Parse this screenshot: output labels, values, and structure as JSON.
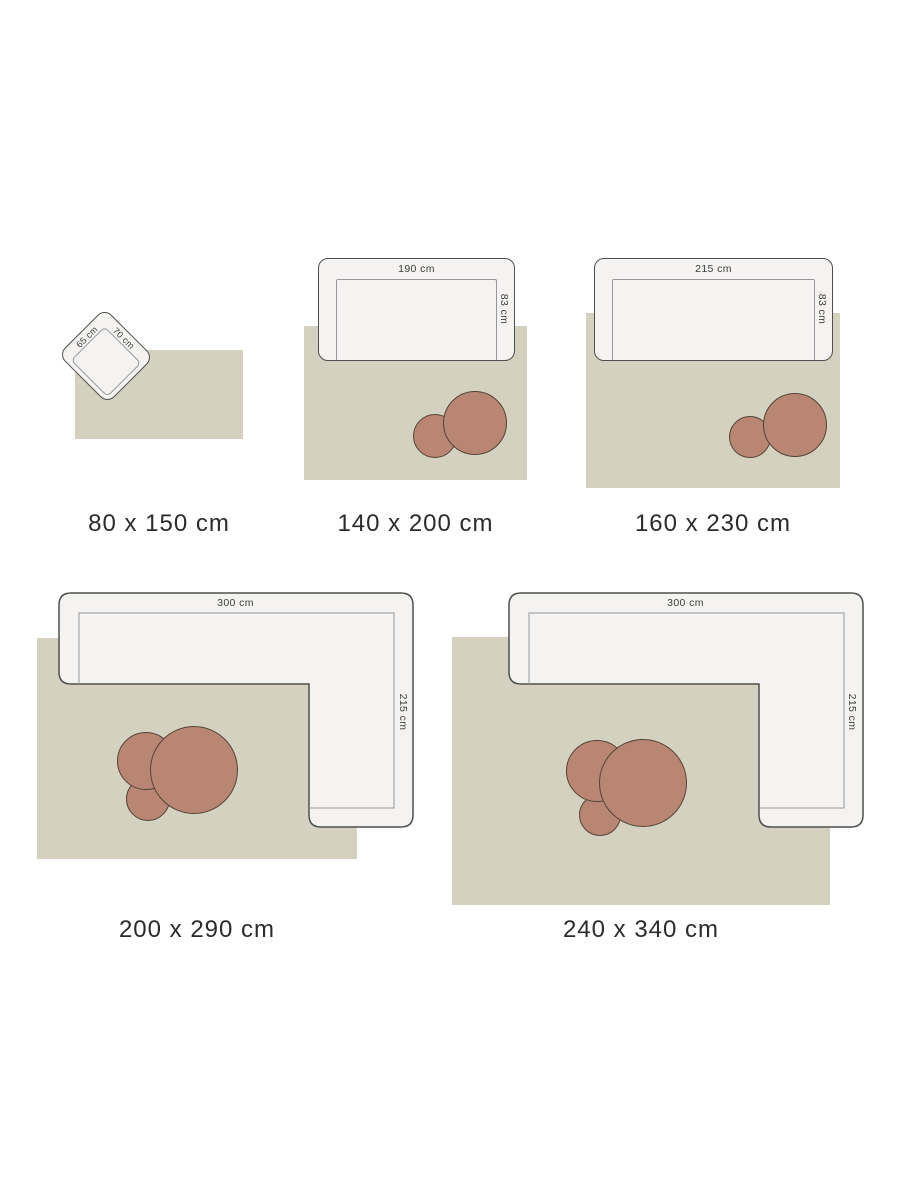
{
  "colors": {
    "rug": "#d4d1c1",
    "sofa_fill": "#f4f3f1",
    "sofa_stroke": "#4f4f4d",
    "seat_line": "#97979a",
    "table_fill": "#b88672",
    "table_stroke": "#544438",
    "label": "#2b2b2b",
    "dim": "#3d3d3d"
  },
  "diagrams": [
    {
      "size_label": "80 x 150 cm",
      "furniture": {
        "type": "armchair",
        "side_label": "65 cm",
        "top_label": "70 cm"
      }
    },
    {
      "size_label": "140 x 200 cm",
      "furniture": {
        "type": "sofa",
        "width_label": "190 cm",
        "depth_label": "83 cm"
      }
    },
    {
      "size_label": "160 x 230 cm",
      "furniture": {
        "type": "sofa",
        "width_label": "215 cm",
        "depth_label": "83 cm"
      }
    },
    {
      "size_label": "200 x 290 cm",
      "furniture": {
        "type": "corner-sofa",
        "width_label": "300 cm",
        "depth_label": "215 cm"
      }
    },
    {
      "size_label": "240 x 340 cm",
      "furniture": {
        "type": "corner-sofa",
        "width_label": "300 cm",
        "depth_label": "215 cm"
      }
    }
  ]
}
